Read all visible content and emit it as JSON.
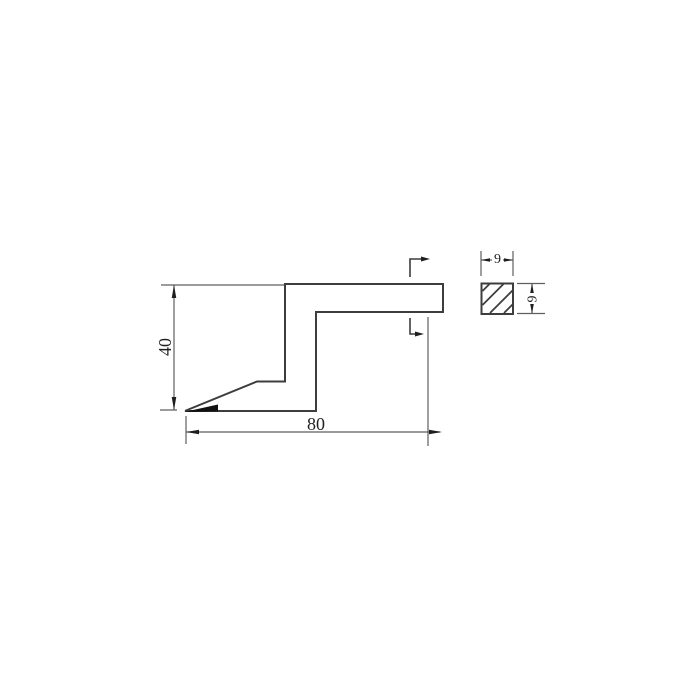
{
  "colors": {
    "outline": "#3d3d3d",
    "dim": "#5f5f5f",
    "text": "#1f1f1f",
    "background": "#ffffff"
  },
  "dimensions": {
    "profile_height": "40",
    "profile_width": "80",
    "section_width": "9",
    "section_height": "9"
  }
}
